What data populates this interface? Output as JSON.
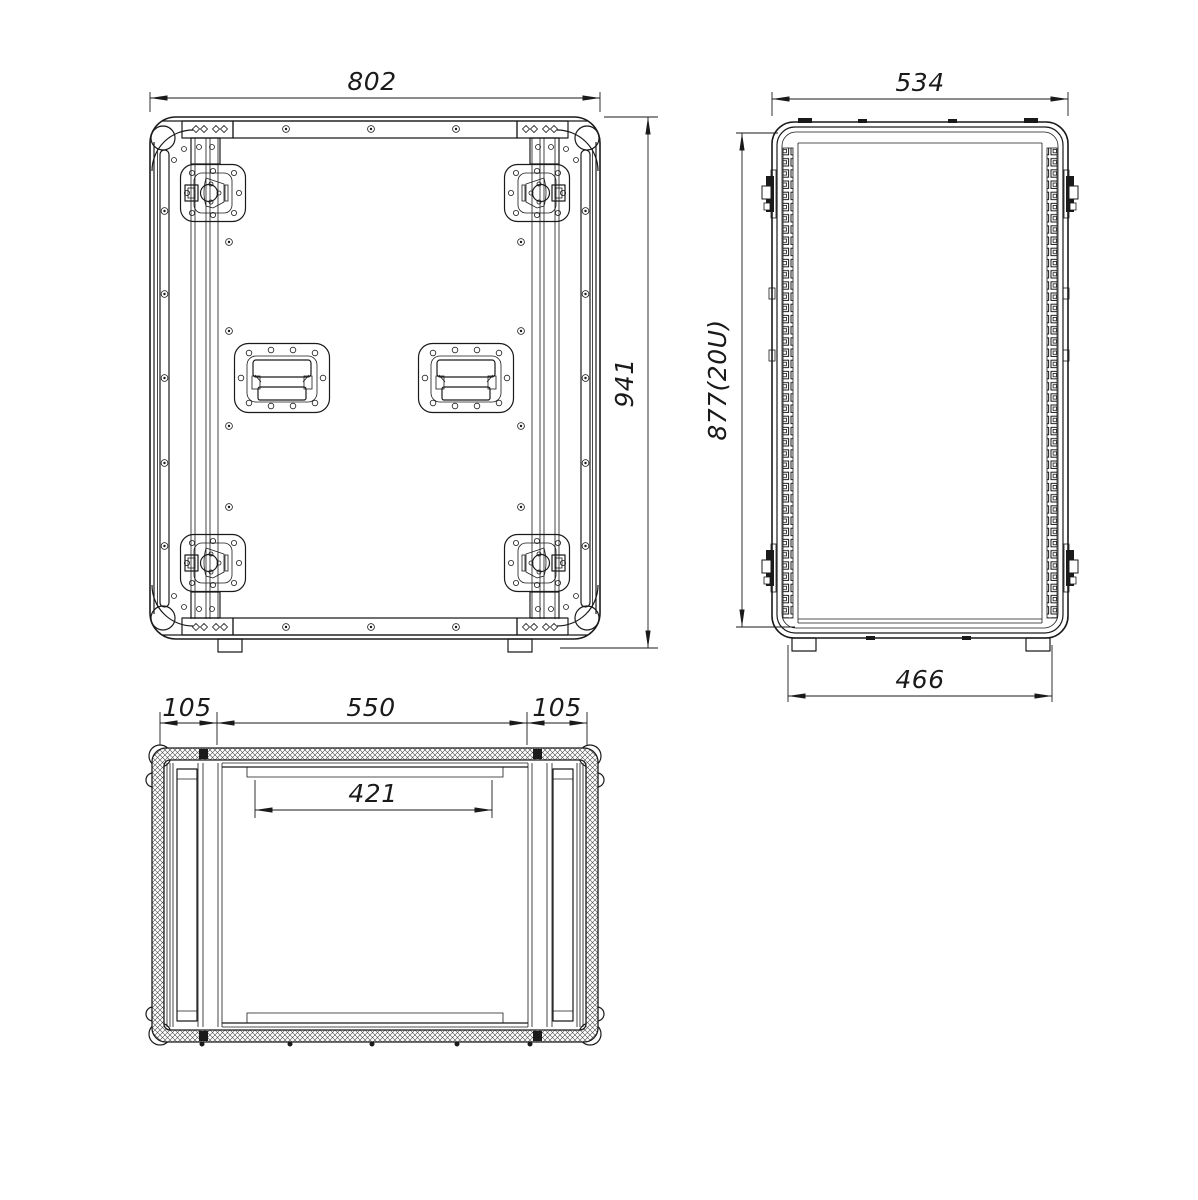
{
  "page": {
    "background": "#ffffff",
    "ink": "#1a1a1a"
  },
  "views": {
    "front": {
      "width_mm": "802",
      "height_mm": "941"
    },
    "side": {
      "width_mm": "534",
      "height_mm": "877(20U)",
      "foot_span_mm": "466"
    },
    "top": {
      "side_wall_left_mm": "105",
      "opening_mm": "550",
      "side_wall_right_mm": "105",
      "rail_span_mm": "421"
    }
  }
}
